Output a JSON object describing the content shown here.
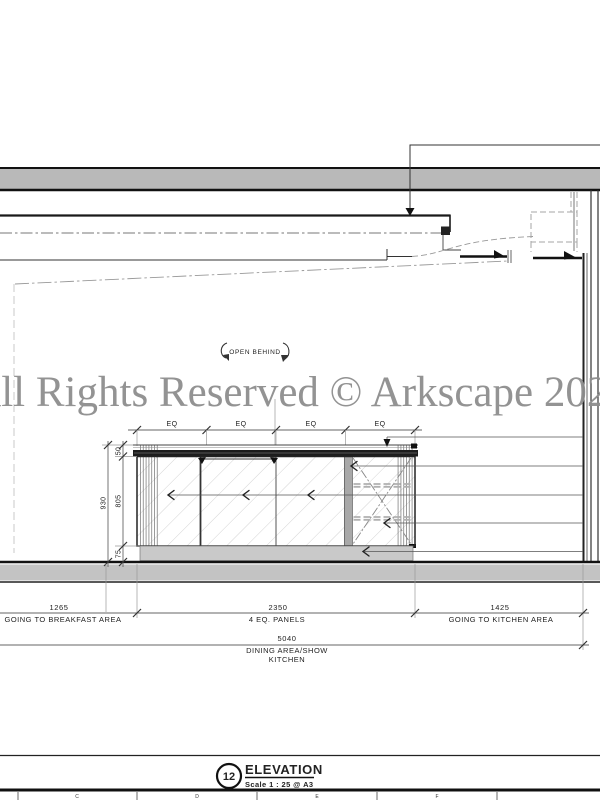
{
  "watermark": {
    "text": "All Rights Reserved © Arkscape 2023",
    "color": "#8e8e8e"
  },
  "annotations": {
    "open_behind": "OPEN BEHIND"
  },
  "dimensions": {
    "eq_labels": [
      "EQ",
      "EQ",
      "EQ",
      "EQ"
    ],
    "vertical": {
      "counter": "50",
      "total": "930",
      "door": "805",
      "plinth": "75"
    },
    "horizontal": [
      {
        "value": "1265",
        "label": "GOING TO BREAKFAST AREA"
      },
      {
        "value": "2350",
        "label": "4 EQ. PANELS"
      },
      {
        "value": "1425",
        "label": "GOING TO KITCHEN AREA"
      }
    ],
    "overall": {
      "value": "5040",
      "label_line1": "DINING AREA/SHOW",
      "label_line2": "KITCHEN"
    }
  },
  "title_block": {
    "number": "12",
    "title": "ELEVATION",
    "scale": "Scale 1 : 25 @ A3"
  },
  "sheet_grid": {
    "letters": [
      "C",
      "D",
      "E",
      "F"
    ]
  },
  "colors": {
    "line": "#222222",
    "slab_fill": "#b9b9b9",
    "floor_fill": "#c3c3c3",
    "plinth_fill": "#c9c9c9",
    "hatch": "#cfcfcf",
    "hidden_line": "#999999"
  }
}
